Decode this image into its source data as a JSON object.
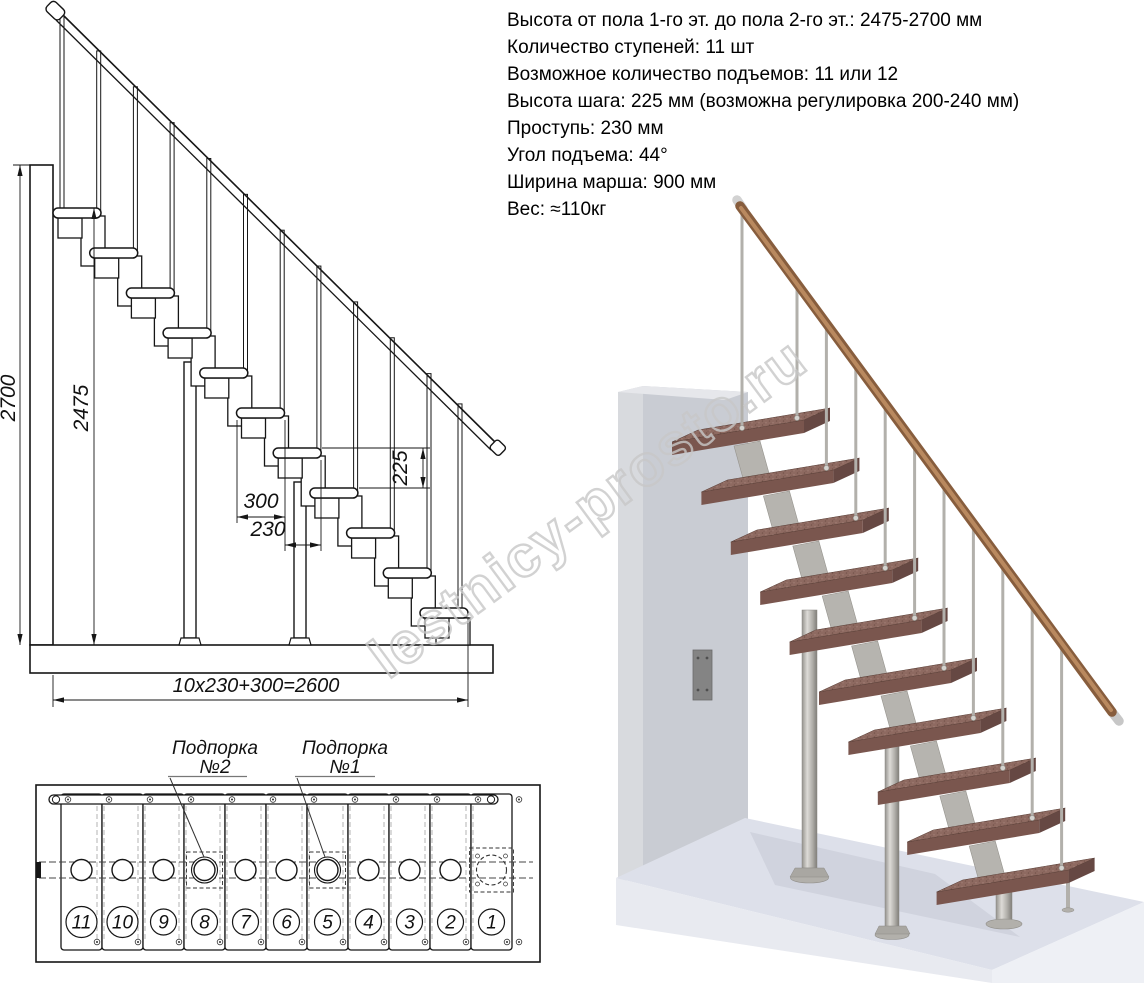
{
  "spec": {
    "lines": [
      "Высота от пола 1-го эт. до пола 2-го эт.: 2475-2700 мм",
      "Количество ступеней: 11 шт",
      "Возможное количество подъемов: 11 или 12",
      "Высота шага: 225 мм (возможна регулировка 200-240 мм)",
      "Проступь: 230 мм",
      "Угол подъема: 44°",
      "Ширина марша: 900 мм",
      "Вес: ≈110кг"
    ]
  },
  "side_view": {
    "dims": {
      "total_height": "2700",
      "to_top_tread": "2475",
      "step_height": "225",
      "tread_depth": "300",
      "step_run": "230",
      "total_run": "10x230+300=2600"
    }
  },
  "plan_view": {
    "step_numbers": [
      "11",
      "10",
      "9",
      "8",
      "7",
      "6",
      "5",
      "4",
      "3",
      "2",
      "1"
    ],
    "support_2": {
      "line1": "Подпорка",
      "line2": "№2"
    },
    "support_1": {
      "line1": "Подпорка",
      "line2": "№1"
    }
  },
  "watermark": {
    "text": "lestnicy-prosto.ru"
  },
  "colors": {
    "line": "#161616",
    "tread_top": "#8e6a61",
    "tread_front": "#7a564e",
    "tread_side": "#664843",
    "handrail_dark": "#875d3d",
    "handrail_light": "#b9895f",
    "metal": "#b2b0ab",
    "wall_front": "#c9ccd3",
    "wall_side": "#d8dade",
    "floor_top": "#dde0ea",
    "floor_front_left": "#e8eaf0",
    "floor_front_right": "#eef0f5",
    "watermark_stroke": "#c8c8c8"
  }
}
